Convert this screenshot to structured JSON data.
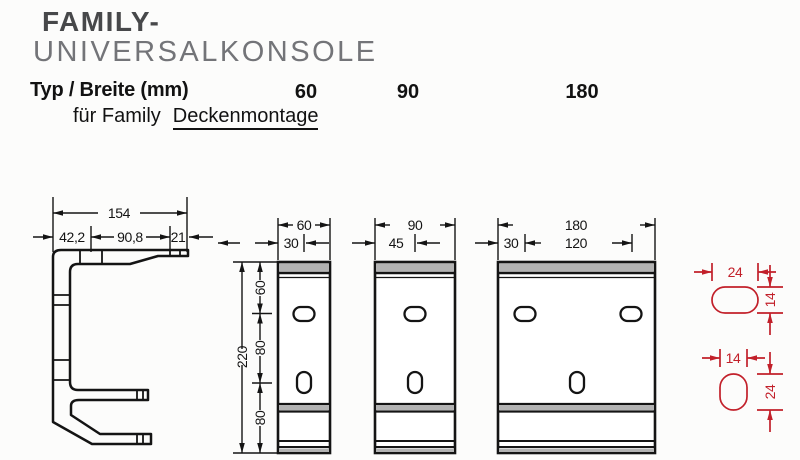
{
  "header": {
    "title_line1": "FAMILY-",
    "title_line2": "UNIVERSALKONSOLE",
    "type_label": "Typ / Breite (mm)",
    "col1": "60",
    "col2": "90",
    "col3": "180",
    "subtitle_prefix": "für Family",
    "subtitle_link": "Deckenmontage"
  },
  "profile": {
    "dim_overall": "154",
    "dim_left": "42,2",
    "dim_mid": "90,8",
    "dim_right": "21"
  },
  "bracket60": {
    "dim_width": "60",
    "dim_center": "30",
    "dim_height": "220",
    "dim_seg1": "60",
    "dim_seg2": "80",
    "dim_seg3": "80"
  },
  "bracket90": {
    "dim_width": "90",
    "dim_center": "45"
  },
  "bracket180": {
    "dim_width": "180",
    "dim_left": "30",
    "dim_mid": "120"
  },
  "slot_top": {
    "dim_width": "24",
    "dim_height": "14"
  },
  "slot_bottom": {
    "dim_width": "14",
    "dim_height": "24"
  },
  "colors": {
    "line": "#141414",
    "band_gray": "#b2b2b2",
    "red": "#c2202a",
    "title_dark": "#47484a",
    "title_light": "#737478"
  }
}
